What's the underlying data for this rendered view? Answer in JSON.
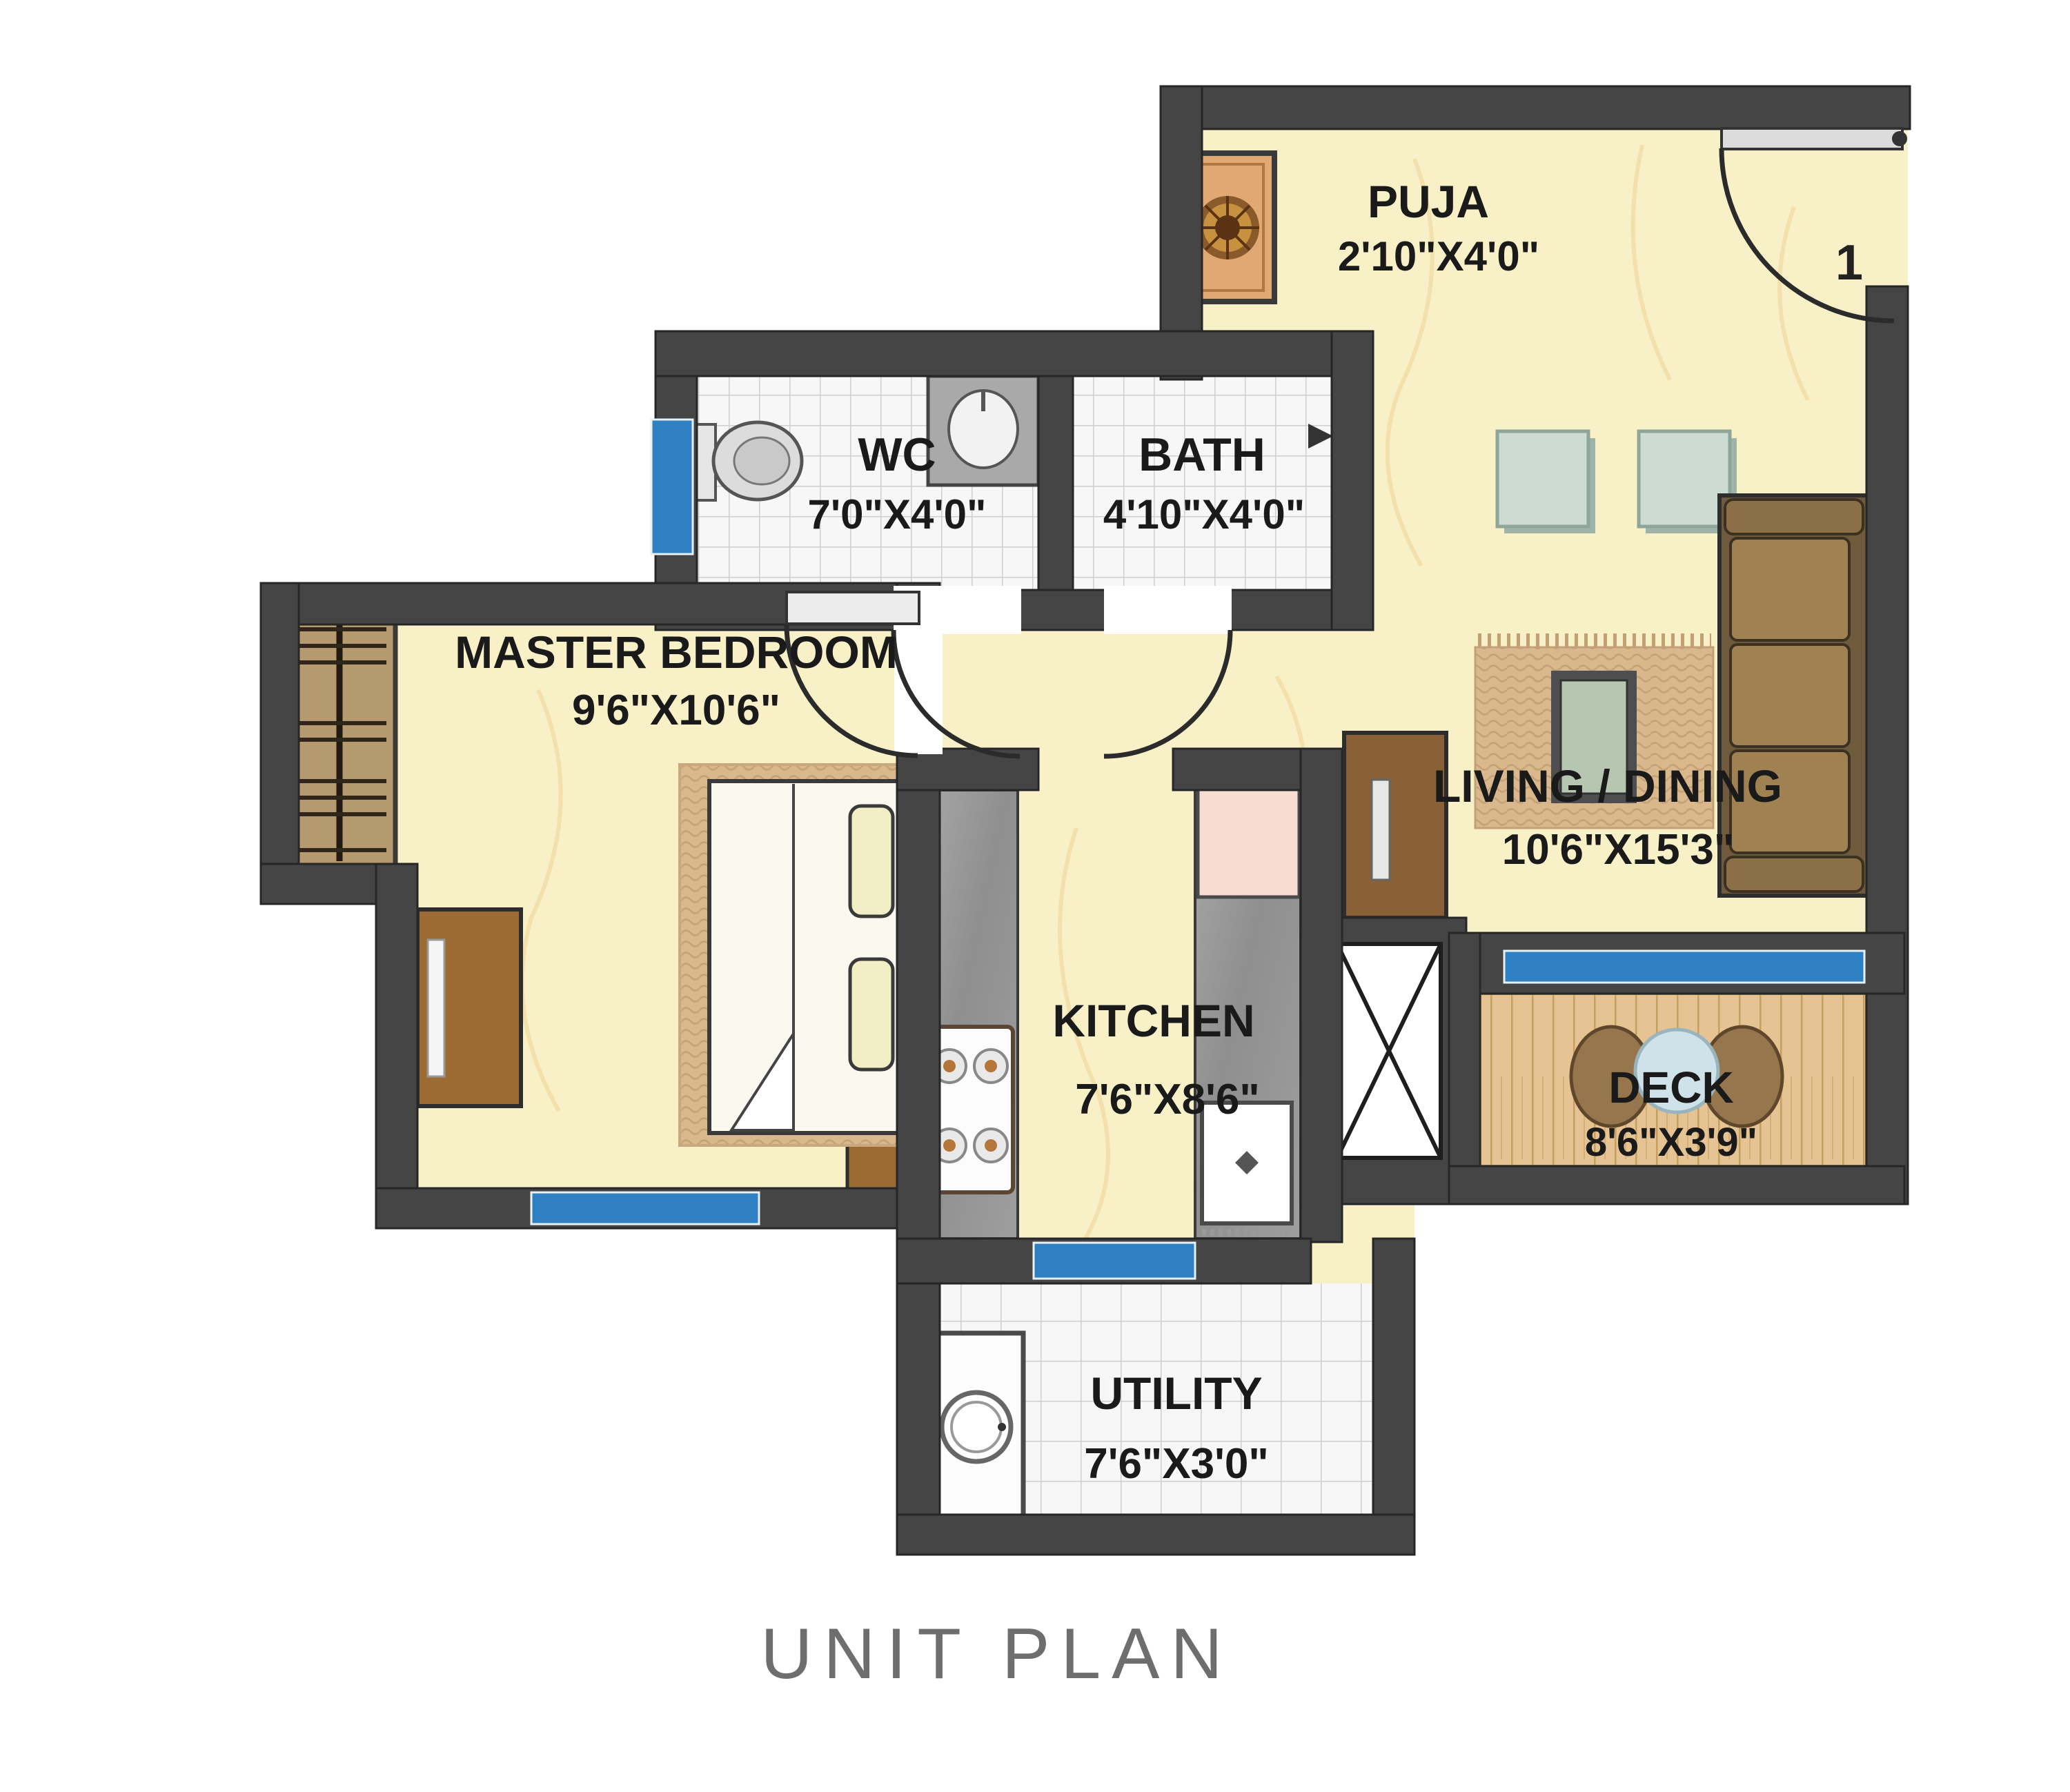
{
  "title": "UNIT PLAN",
  "entry": {
    "door_number": "1"
  },
  "rooms": {
    "puja": {
      "name": "PUJA",
      "dims": "2'10\"X4'0\""
    },
    "wc": {
      "name": "WC",
      "dims": "7'0\"X4'0\""
    },
    "bath": {
      "name": "BATH",
      "dims": "4'10\"X4'0\""
    },
    "master_bedroom": {
      "name": "MASTER BEDROOM",
      "dims": "9'6\"X10'6\""
    },
    "living_dining": {
      "name": "LIVING / DINING",
      "dims": "10'6\"X15'3\""
    },
    "kitchen": {
      "name": "KITCHEN",
      "dims": "7'6\"X8'6\""
    },
    "deck": {
      "name": "DECK",
      "dims": "8'6\"X3'9\""
    },
    "utility": {
      "name": "UTILITY",
      "dims": "7'6\"X3'0\""
    }
  },
  "colors": {
    "wall": "#454545",
    "floor": "#f8f1c8",
    "floor_vein": "#f3d9a2",
    "tile": "#f7f7f7",
    "tile_line": "#cfcfcf",
    "window_blue": "#2e80c2",
    "deck_wood": "#e5c392",
    "counter_gray": "#9b9b9b",
    "furniture_brown": "#a08252",
    "label_text": "#1a1a1a",
    "title_text": "#6e6e6e"
  }
}
